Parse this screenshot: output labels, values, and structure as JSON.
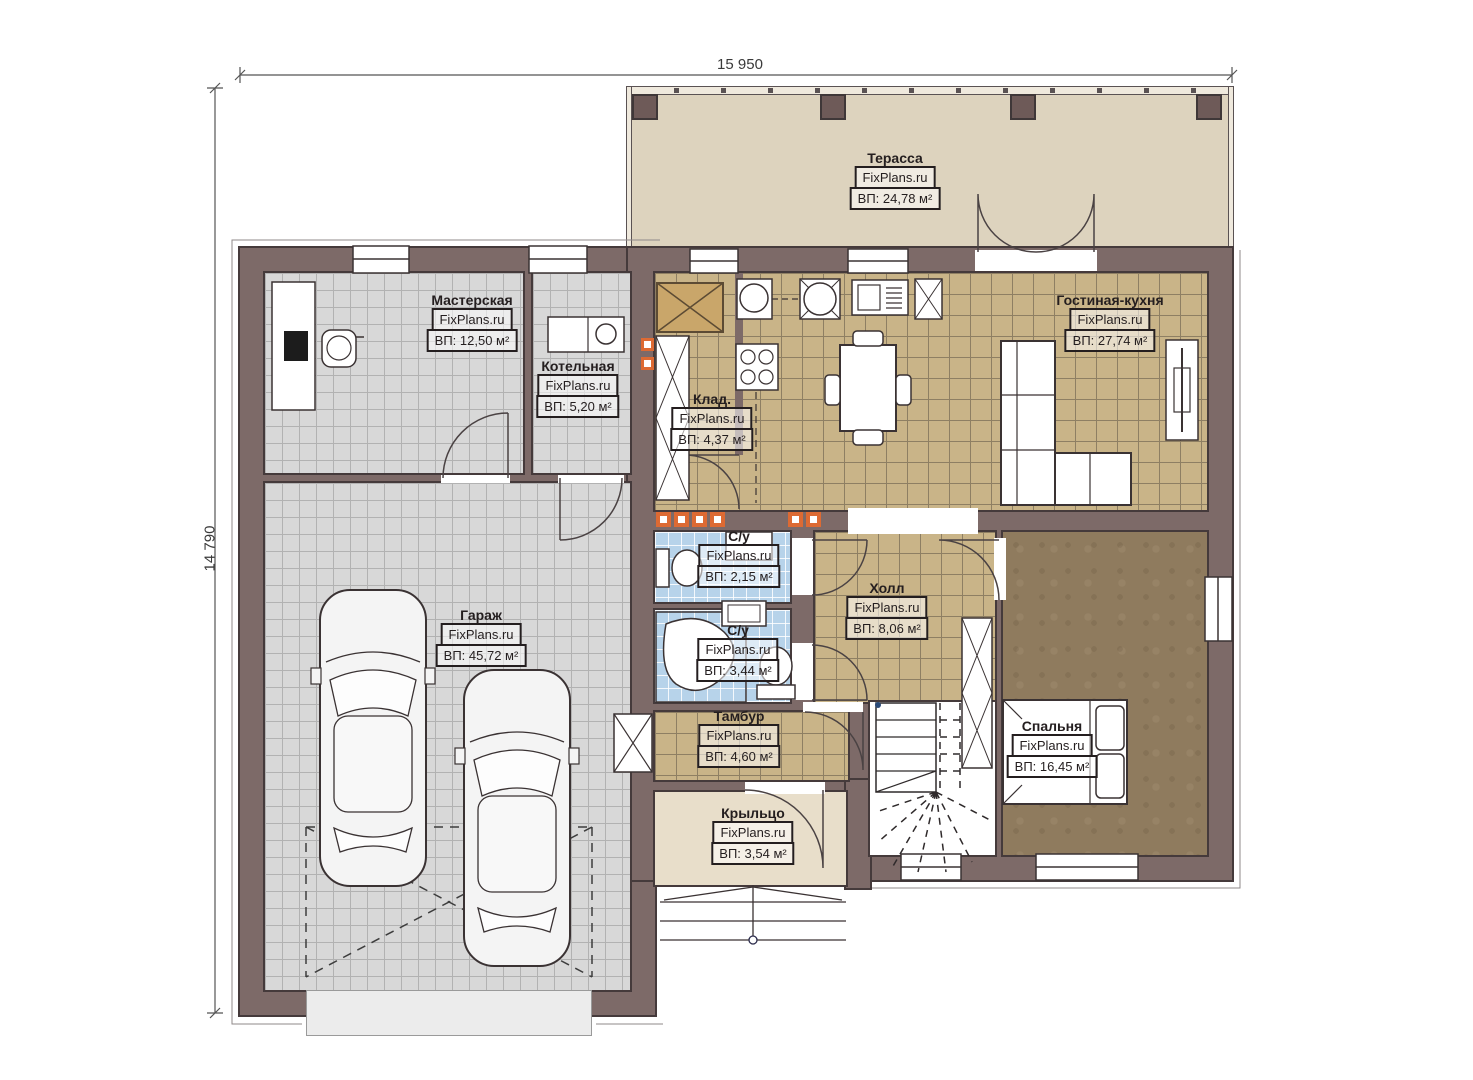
{
  "watermark": "FixPlans.ru",
  "dimensions": {
    "top": "15 950",
    "left": "14 790"
  },
  "rooms": [
    {
      "id": "terrace",
      "name": "Терасса",
      "area": "ВП: 24,78 м²"
    },
    {
      "id": "workshop",
      "name": "Мастерская",
      "area": "ВП: 12,50 м²"
    },
    {
      "id": "boiler",
      "name": "Котельная",
      "area": "ВП: 5,20 м²"
    },
    {
      "id": "storage",
      "name": "Клад.",
      "area": "ВП: 4,37 м²"
    },
    {
      "id": "living_kitchen",
      "name": "Гостиная-кухня",
      "area": "ВП: 27,74 м²"
    },
    {
      "id": "garage",
      "name": "Гараж",
      "area": "ВП: 45,72 м²"
    },
    {
      "id": "wc1",
      "name": "С/у",
      "area": "ВП: 2,15 м²"
    },
    {
      "id": "wc2",
      "name": "С/у",
      "area": "ВП: 3,44 м²"
    },
    {
      "id": "hall",
      "name": "Холл",
      "area": "ВП: 8,06 м²"
    },
    {
      "id": "vestibule",
      "name": "Тамбур",
      "area": "ВП: 4,60 м²"
    },
    {
      "id": "bedroom",
      "name": "Спальня",
      "area": "ВП: 16,45 м²"
    },
    {
      "id": "porch",
      "name": "Крыльцо",
      "area": "ВП: 3,54 м²"
    }
  ],
  "colors": {
    "wall": "#7d6a68",
    "wall_outline": "#453a3b",
    "terrace_floor": "#ddd3be",
    "tile_tan": "#c9b488",
    "tile_gray": "#d8d8d8",
    "tile_blue": "#b7d3ea",
    "bedroom_floor": "#8f7b5e",
    "porch_floor": "#e8deca",
    "vent_accent": "#dd6a33"
  }
}
